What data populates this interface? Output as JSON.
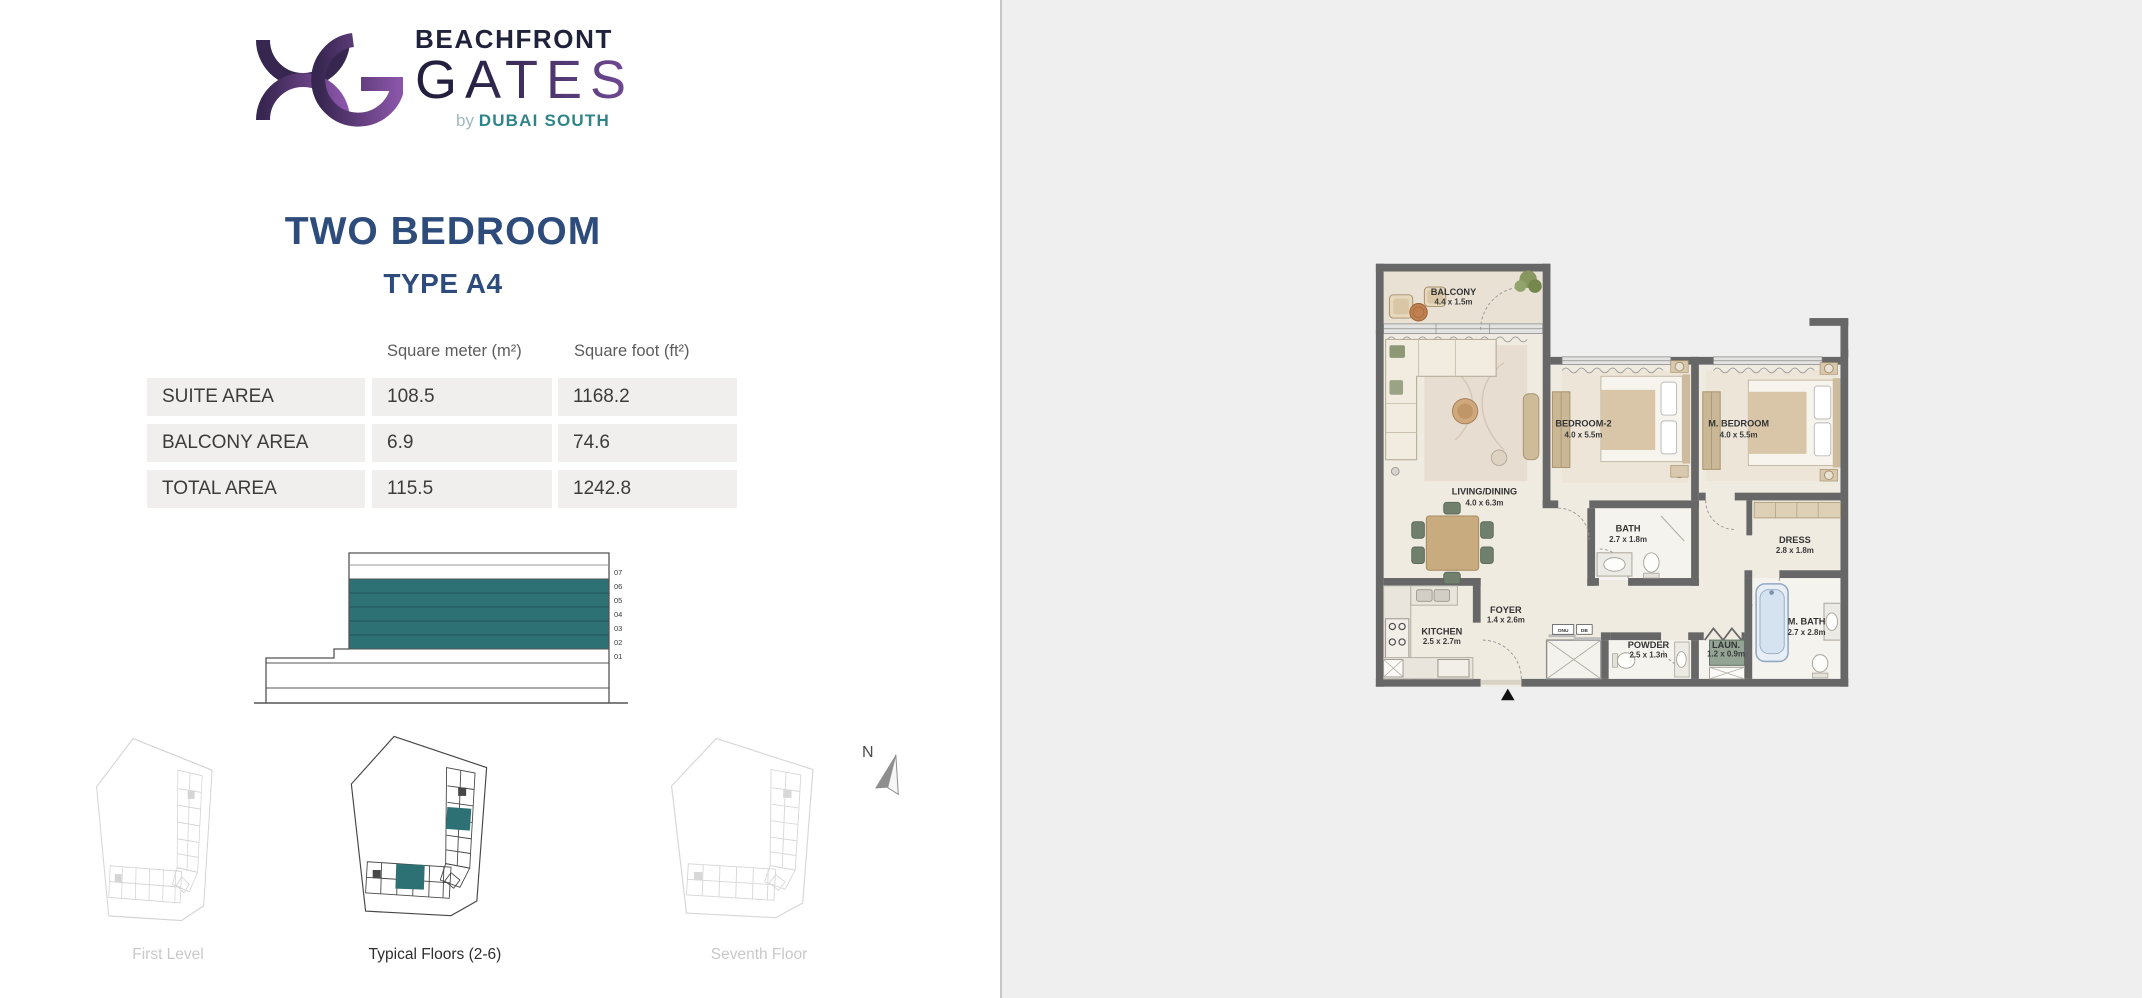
{
  "brand": {
    "line1": "BEACHFRONT",
    "line2": "GATES",
    "tagline_by": "by",
    "tagline_owner": "DUBAI SOUTH",
    "colors": {
      "purple_dark": "#372650",
      "purple_light": "#8a55a8",
      "navy": "#20223c",
      "teal_brand": "#2e8488"
    }
  },
  "header": {
    "title": "TWO BEDROOM",
    "subtitle": "TYPE A4"
  },
  "areas": {
    "col_headers": [
      "Square meter (m²)",
      "Square foot (ft²)"
    ],
    "rows": [
      {
        "label": "SUITE AREA",
        "sqm": "108.5",
        "sqft": "1168.2"
      },
      {
        "label": "BALCONY AREA",
        "sqm": "6.9",
        "sqft": "74.6"
      },
      {
        "label": "TOTAL AREA",
        "sqm": "115.5",
        "sqft": "1242.8"
      }
    ]
  },
  "elevation": {
    "floors": [
      "07",
      "06",
      "05",
      "04",
      "03",
      "02",
      "01"
    ],
    "highlighted_floors": [
      "06",
      "05",
      "04",
      "03",
      "02"
    ],
    "highlight_color": "#2d7175"
  },
  "thumbnails": [
    {
      "label": "First Level",
      "active": false
    },
    {
      "label": "Typical Floors (2-6)",
      "active": true
    },
    {
      "label": "Seventh Floor",
      "active": false
    }
  ],
  "compass": {
    "label": "N"
  },
  "floorplan": {
    "rooms": [
      {
        "name": "BALCONY",
        "dim": "4.4 x 1.5m"
      },
      {
        "name": "LIVING/DINING",
        "dim": "4.0 x 6.3m"
      },
      {
        "name": "BEDROOM-2",
        "dim": "4.0 x 5.5m"
      },
      {
        "name": "M. BEDROOM",
        "dim": "4.0 x 5.5m"
      },
      {
        "name": "BATH",
        "dim": "2.7 x 1.8m"
      },
      {
        "name": "DRESS",
        "dim": "2.8 x 1.8m"
      },
      {
        "name": "KITCHEN",
        "dim": "2.5 x 2.7m"
      },
      {
        "name": "FOYER",
        "dim": "1.4 x 2.6m"
      },
      {
        "name": "POWDER",
        "dim": "2.5 x 1.3m"
      },
      {
        "name": "LAUN.",
        "dim": "1.2 x 0.9m"
      },
      {
        "name": "M. BATH",
        "dim": "2.7 x 2.8m"
      }
    ],
    "small_labels": [
      "ONU",
      "DB"
    ]
  }
}
